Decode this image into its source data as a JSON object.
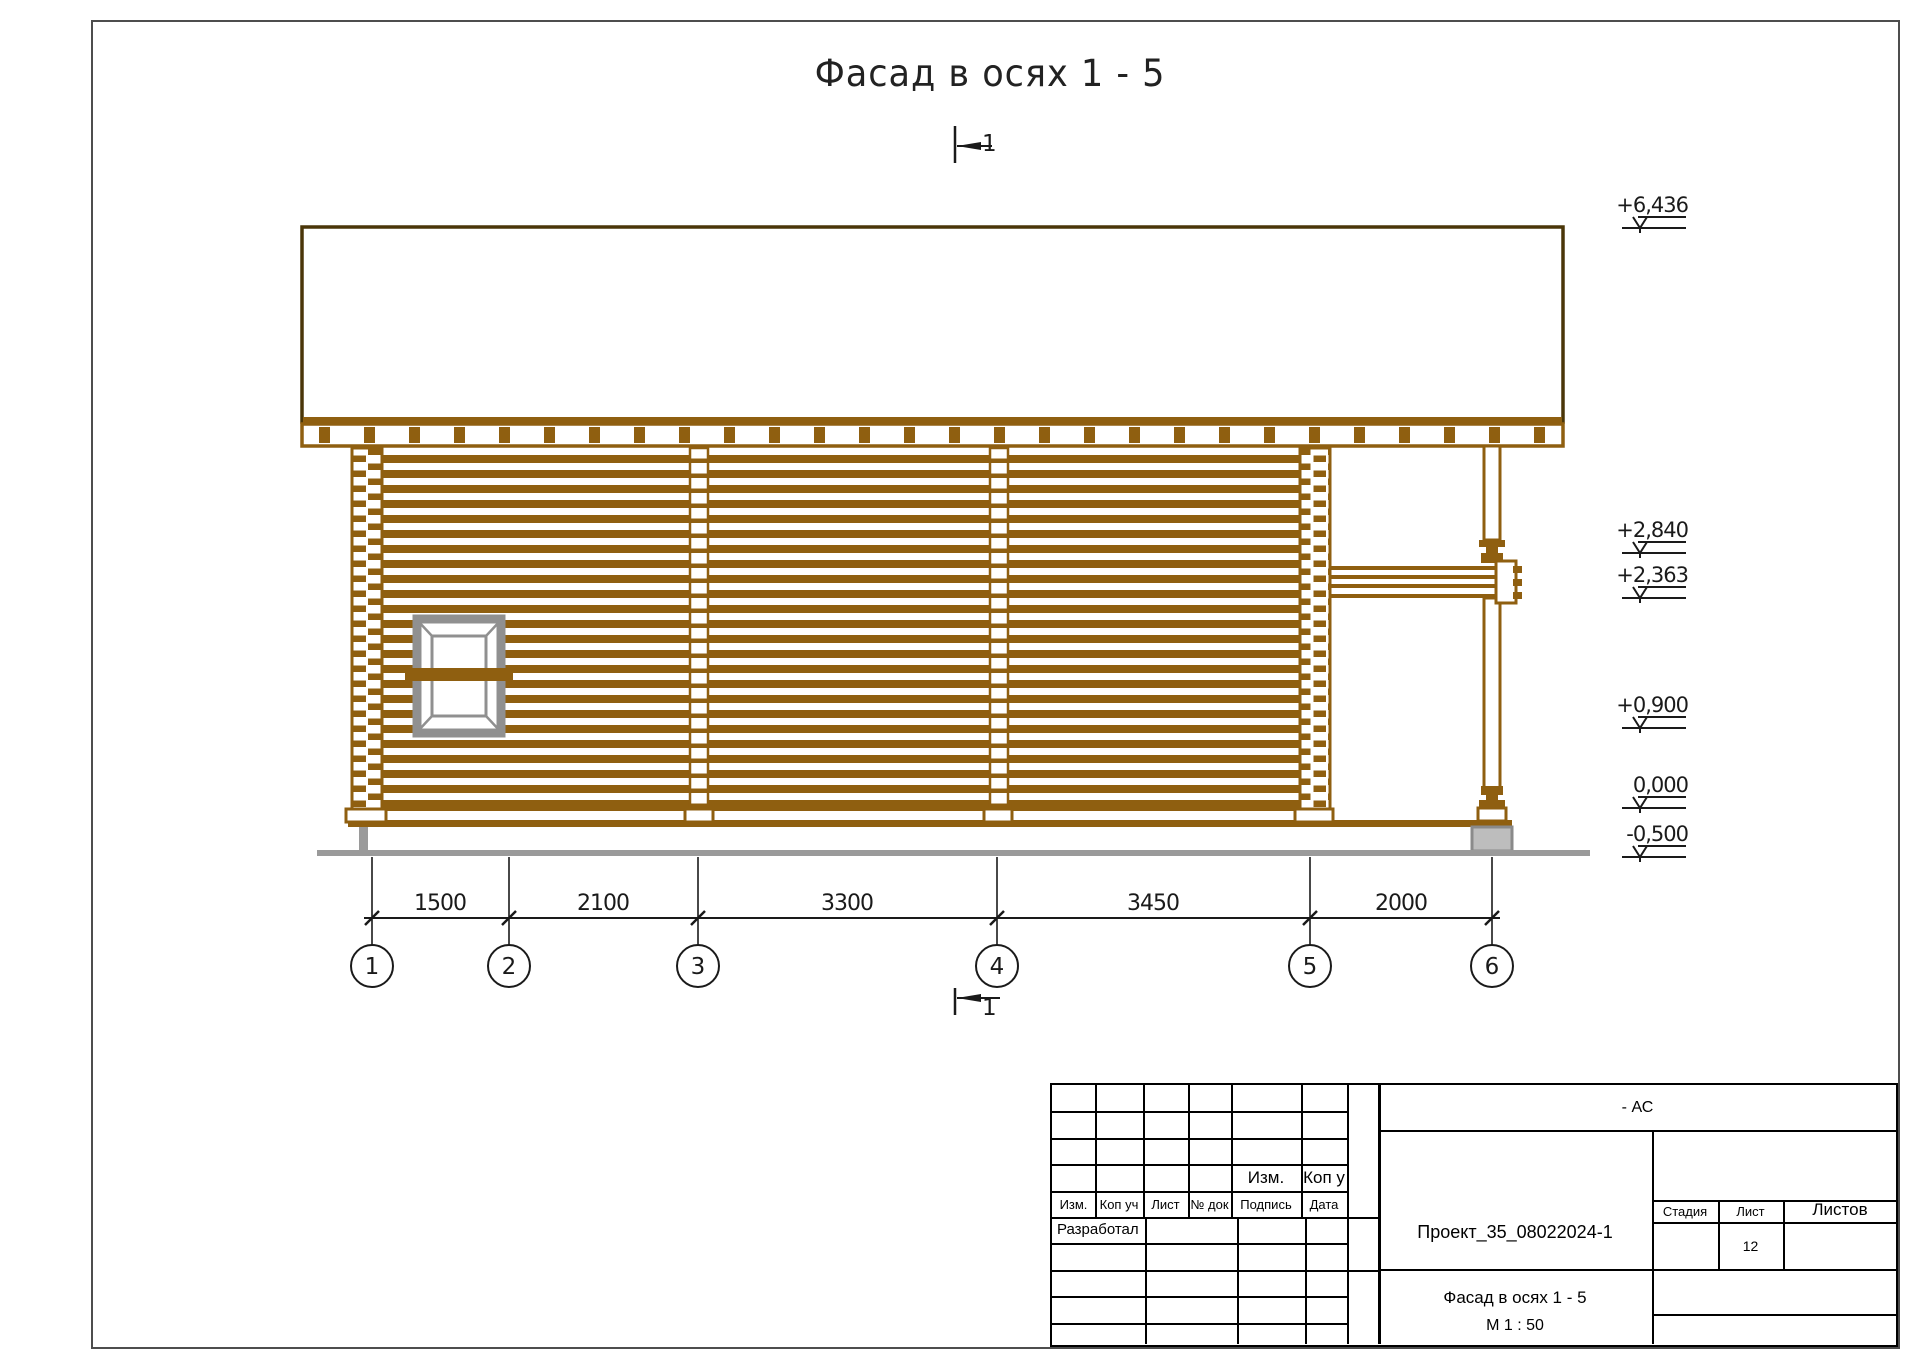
{
  "sheet": {
    "title": "Фасад в осях 1 - 5",
    "section_mark_label": "1"
  },
  "elevation_marks": [
    {
      "value": "+6,436"
    },
    {
      "value": "+2,840"
    },
    {
      "value": "+2,363"
    },
    {
      "value": "+0,900"
    },
    {
      "value": "0,000"
    },
    {
      "value": "-0,500"
    }
  ],
  "dimensions_mm": [
    {
      "value": "1500"
    },
    {
      "value": "2100"
    },
    {
      "value": "3300"
    },
    {
      "value": "3450"
    },
    {
      "value": "2000"
    }
  ],
  "axes": [
    {
      "label": "1"
    },
    {
      "label": "2"
    },
    {
      "label": "3"
    },
    {
      "label": "4"
    },
    {
      "label": "5"
    },
    {
      "label": "6"
    }
  ],
  "title_block": {
    "set_code": "- АС",
    "project_code": "Проект_35_08022024-1",
    "drawing_name": "Фасад в осях 1 - 5",
    "scale": "М 1 : 50",
    "stage_label": "Стадия",
    "sheet_label": "Лист",
    "sheets_label": "Листов",
    "sheet_number": "12",
    "pre_header_left": "Изм.",
    "pre_header_right": "Коп у",
    "revision_header": [
      {
        "label": "Изм."
      },
      {
        "label": "Коп уч"
      },
      {
        "label": "Лист"
      },
      {
        "label": "№ док"
      },
      {
        "label": "Подпись"
      },
      {
        "label": "Дата"
      }
    ],
    "developed_label": "Разработал"
  },
  "colors": {
    "log_brown": "#8f5f10",
    "roof_outline": "#4a3608",
    "foundation_gray": "#9a9a9a",
    "window_gray": "#909090",
    "line_black": "#1a1a1a"
  }
}
